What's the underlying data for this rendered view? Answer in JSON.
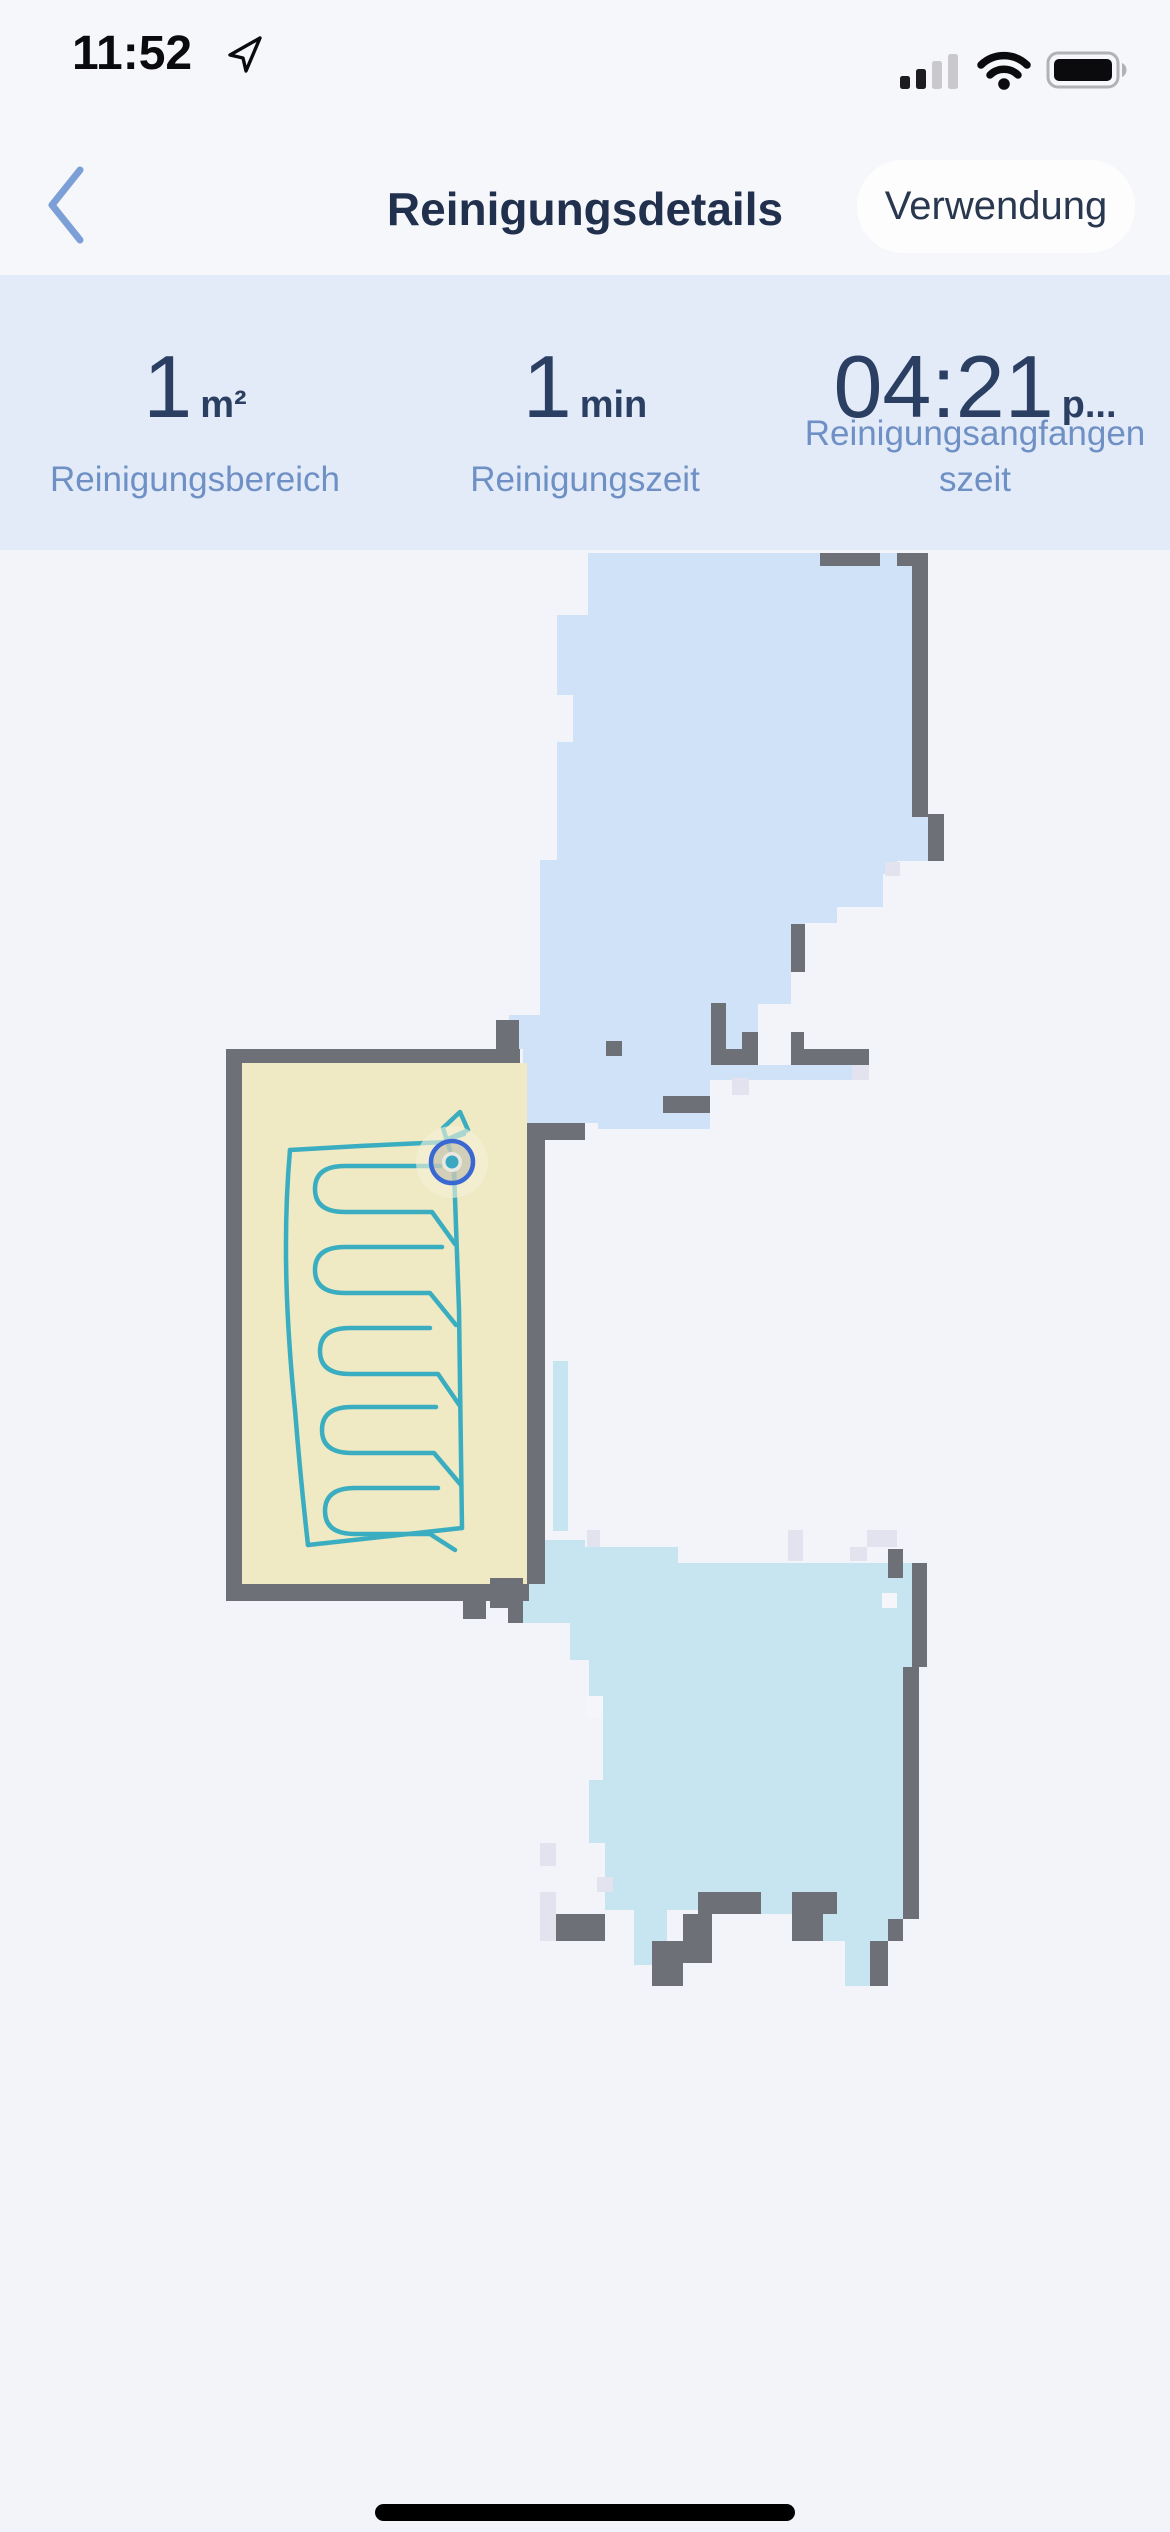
{
  "status_bar": {
    "time": "11:52"
  },
  "nav": {
    "title": "Reinigungsdetails",
    "action_label": "Verwendung"
  },
  "stats": [
    {
      "value": "1",
      "unit": "m²",
      "label_line1": "Reinigungsbereich",
      "label_line2": ""
    },
    {
      "value": "1",
      "unit": "min",
      "label_line1": "Reinigungszeit",
      "label_line2": ""
    },
    {
      "value": "04:21",
      "unit": "p...",
      "label_line1": "Reinigungsangfangen",
      "label_line2": "szeit"
    }
  ],
  "map": {
    "colors": {
      "bg": "#f2f4f9",
      "room_blue": "#cfe2f7",
      "room_cyan": "#c6e5f0",
      "room_yellow": "#efe9c4",
      "wall": "#6d7077",
      "lavender": "#e3e3f0",
      "white": "#f4f6fa",
      "path": "#3aaec0",
      "robot_ring": "#3a68d3",
      "robot_dot": "#3aa8c0",
      "robot_fill": "rgba(168,168,155,0.45)",
      "robot_inner": "#e9e9e1",
      "glow": "rgba(246,241,216,0.6)"
    },
    "rooms": [
      {
        "name": "upper-room",
        "color": "room_blue",
        "points": "588,3 912,3 912,264 928,264 928,311 897,311 897,324 883,324 883,357 837,357 837,373 805,373 805,422 791,422 791,454 758,454 758,483 743,483 743,515 869,515 869,530 710,530 710,579 598,579 598,573 523,573 523,499 509,499 509,465 540,465 540,310 557,310 557,192 573,192 573,145 557,145 557,65 588,65"
      },
      {
        "name": "lower-room",
        "color": "room_cyan",
        "points": "508,1013 523,1013 523,990 585,990 585,997 678,997 678,1013 919,1013 919,1369 903,1369 903,1391 888,1391 888,1436 845,1436 845,1391 823,1391 823,1364 761,1364 761,1360 667,1360 667,1415 634,1415 634,1360 605,1360 605,1293 589,1293 589,1230 603,1230 603,1168 589,1168 589,1110 570,1110 570,1073 523,1073 523,1058 508,1058"
      },
      {
        "name": "cleaned-room",
        "color": "room_yellow",
        "points": "242,513 527,513 527,1034 242,1034"
      }
    ],
    "rects": [
      [
        553,
        811,
        15,
        170,
        "room_cyan"
      ],
      [
        820,
        3,
        60,
        13,
        "wall"
      ],
      [
        897,
        3,
        31,
        13,
        "wall"
      ],
      [
        912,
        15,
        16,
        252,
        "wall"
      ],
      [
        928,
        264,
        16,
        47,
        "wall"
      ],
      [
        791,
        374,
        14,
        48,
        "wall"
      ],
      [
        742,
        482,
        16,
        33,
        "wall"
      ],
      [
        711,
        453,
        15,
        62,
        "wall"
      ],
      [
        711,
        499,
        47,
        16,
        "wall"
      ],
      [
        791,
        499,
        78,
        16,
        "wall"
      ],
      [
        791,
        482,
        13,
        17,
        "wall"
      ],
      [
        663,
        546,
        47,
        17,
        "wall"
      ],
      [
        606,
        491,
        16,
        15,
        "wall"
      ],
      [
        496,
        470,
        23,
        29,
        "wall"
      ],
      [
        226,
        499,
        16,
        552,
        "wall"
      ],
      [
        226,
        499,
        294,
        14,
        "wall"
      ],
      [
        527,
        573,
        18,
        461,
        "wall"
      ],
      [
        527,
        573,
        58,
        17,
        "wall"
      ],
      [
        226,
        1034,
        303,
        17,
        "wall"
      ],
      [
        463,
        1051,
        23,
        18,
        "wall"
      ],
      [
        490,
        1028,
        33,
        30,
        "wall"
      ],
      [
        508,
        1058,
        15,
        15,
        "wall"
      ],
      [
        912,
        1013,
        15,
        104,
        "wall"
      ],
      [
        903,
        1117,
        16,
        252,
        "wall"
      ],
      [
        888,
        1369,
        15,
        22,
        "wall"
      ],
      [
        870,
        1391,
        18,
        45,
        "wall"
      ],
      [
        888,
        999,
        15,
        29,
        "wall"
      ],
      [
        698,
        1342,
        63,
        22,
        "wall"
      ],
      [
        792,
        1342,
        45,
        22,
        "wall"
      ],
      [
        792,
        1364,
        31,
        27,
        "wall"
      ],
      [
        683,
        1364,
        29,
        49,
        "wall"
      ],
      [
        652,
        1391,
        31,
        45,
        "wall"
      ],
      [
        556,
        1364,
        49,
        27,
        "wall"
      ],
      [
        732,
        528,
        17,
        17,
        "lavender"
      ],
      [
        852,
        515,
        17,
        15,
        "lavender"
      ],
      [
        885,
        312,
        15,
        14,
        "lavender"
      ],
      [
        587,
        980,
        13,
        17,
        "lavender"
      ],
      [
        788,
        980,
        15,
        31,
        "lavender"
      ],
      [
        850,
        997,
        17,
        14,
        "lavender"
      ],
      [
        867,
        980,
        30,
        17,
        "lavender"
      ],
      [
        540,
        1293,
        16,
        23,
        "lavender"
      ],
      [
        597,
        1327,
        16,
        15,
        "lavender"
      ],
      [
        540,
        1342,
        16,
        49,
        "lavender"
      ],
      [
        587,
        1146,
        16,
        22,
        "white"
      ],
      [
        882,
        1043,
        15,
        15,
        "white"
      ]
    ],
    "path_segments": [
      "M450,600 L443,578 L460,562 L468,580 L446,590 L464,584",
      "M446,592 L360,596 L290,600",
      "M290,600 C282,690 287,780 295,860 C299,910 304,960 308,995",
      "M308,995 L390,986 L462,978",
      "M454,620 L459,760 L462,978",
      "M440,616 L345,616 Q315,616 315,639 Q315,662 345,662 L432,662 L455,694",
      "M442,697 L345,697 Q315,697 315,720 Q315,743 345,743 L430,743 L456,775",
      "M430,778 L350,778 Q320,778 320,801 Q320,824 350,824 L438,824 L460,856",
      "M436,857 L352,857 Q322,857 322,880 Q322,903 352,903 L434,903 L461,935",
      "M438,938 L355,938 Q325,938 325,961 Q325,984 355,984 L430,984 L455,1000"
    ],
    "robot": {
      "cx": 452,
      "cy": 612,
      "glow_r": 36,
      "ring_r": 21,
      "inner_r": 10,
      "dot_r": 6.5
    }
  }
}
